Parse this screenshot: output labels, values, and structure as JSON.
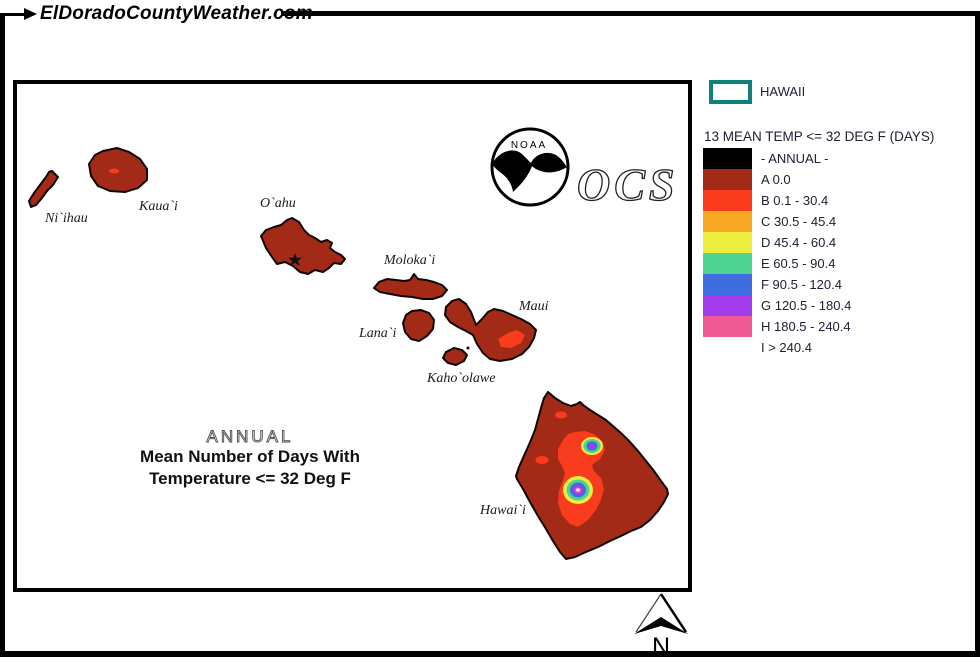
{
  "header": {
    "site_title": "ElDoradoCountyWeather.com"
  },
  "legend": {
    "region_label": "HAWAII",
    "region_border_color": "#0e8178",
    "title": "13 MEAN TEMP <= 32 DEG F (DAYS)",
    "classes": [
      {
        "label": "- ANNUAL -",
        "color": "#000000"
      },
      {
        "label": "A 0.0",
        "color": "#a32a17"
      },
      {
        "label": "B 0.1 - 30.4",
        "color": "#f93b1e"
      },
      {
        "label": "C 30.5 - 45.4",
        "color": "#f7a724"
      },
      {
        "label": "D 45.4 - 60.4",
        "color": "#eeee3f"
      },
      {
        "label": "E 60.5 - 90.4",
        "color": "#4dd492"
      },
      {
        "label": "F 90.5 - 120.4",
        "color": "#3f6ce0"
      },
      {
        "label": "G 120.5 - 180.4",
        "color": "#a23cec"
      },
      {
        "label": "H 180.5 - 240.4",
        "color": "#ef5c95"
      },
      {
        "label": "I > 240.4",
        "color": "#ffffff"
      }
    ]
  },
  "map": {
    "period_label": "ANNUAL",
    "subtitle_line1": "Mean Number of Days With",
    "subtitle_line2": "Temperature <= 32 Deg F",
    "island_labels": [
      "Ni`ihau",
      "Kaua`i",
      "O`ahu",
      "Moloka`i",
      "Maui",
      "Lana`i",
      "Kaho`olawe",
      "Hawai`i"
    ],
    "compass_label": "N"
  },
  "logos": {
    "noaa_text": "NOAA",
    "ocs_text": "OCS"
  }
}
